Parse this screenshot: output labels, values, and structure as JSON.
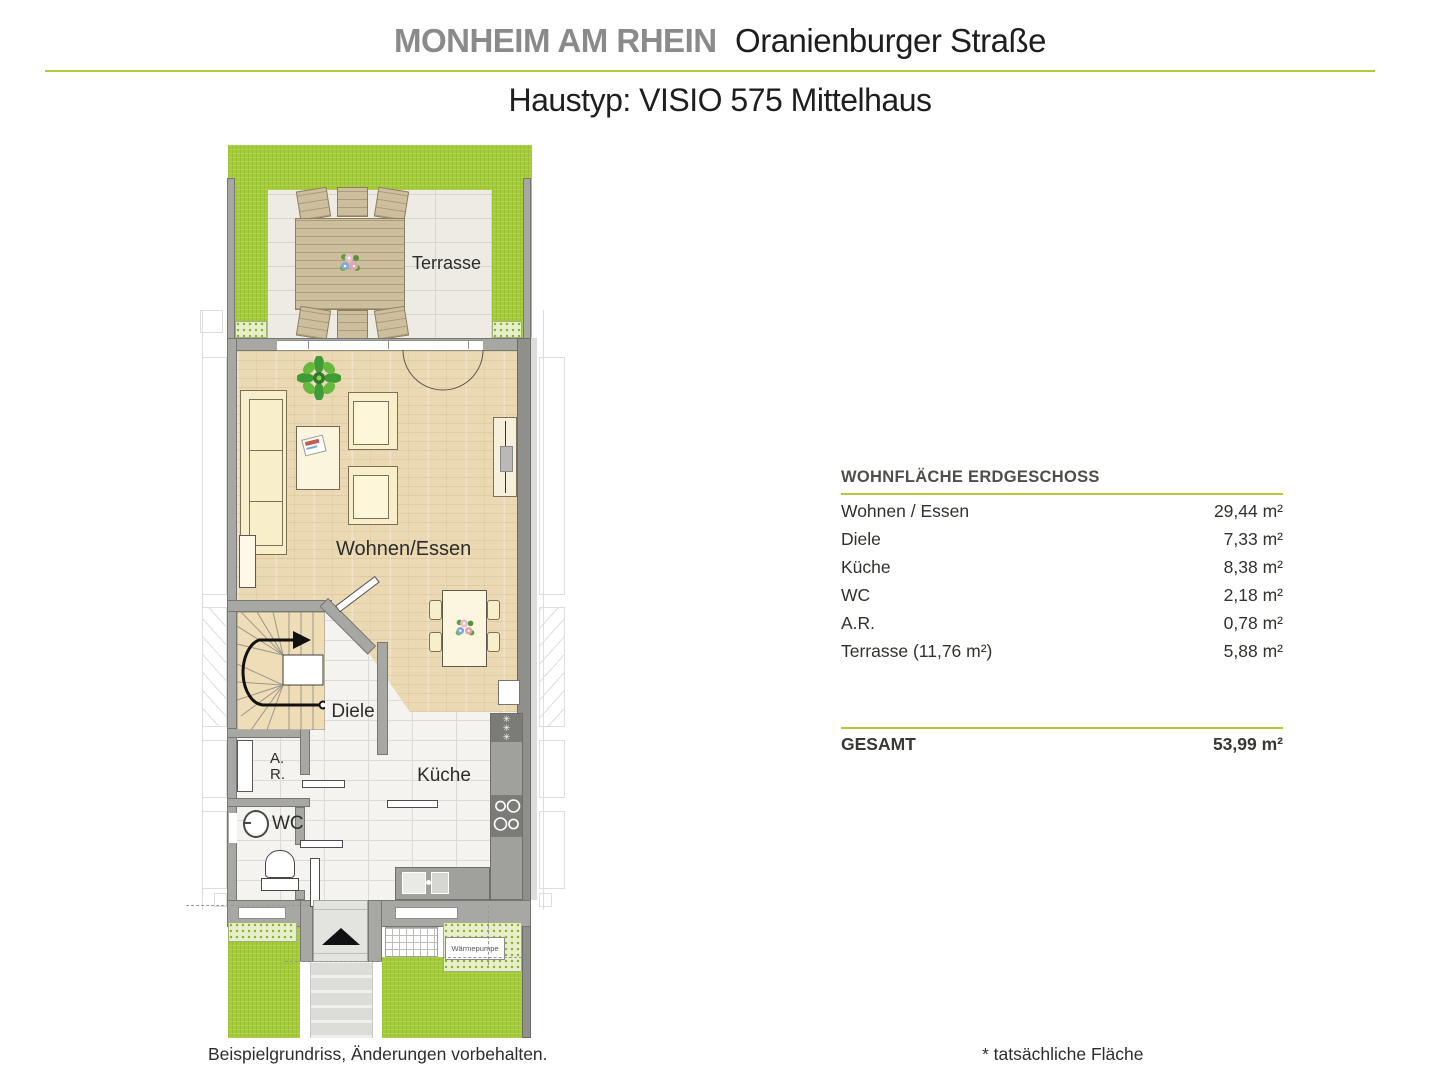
{
  "header": {
    "location": "MONHEIM AM RHEIN",
    "street": "Oranienburger Straße",
    "subtitle": "Haustyp: VISIO 575 Mittelhaus"
  },
  "plan_labels": {
    "terrasse": "Terrasse",
    "wohnen_essen": "Wohnen/Essen",
    "diele": "Diele",
    "ar_line1": "A.",
    "ar_line2": "R.",
    "wc": "WC",
    "kueche": "Küche",
    "waermepumpe": "Wärmepumpe"
  },
  "area_table": {
    "title": "WOHNFLÄCHE ERDGESCHOSS",
    "rows": [
      {
        "label": "Wohnen / Essen",
        "value": "29,44 m²"
      },
      {
        "label": "Diele",
        "value": "7,33 m²"
      },
      {
        "label": "Küche",
        "value": "8,38 m²"
      },
      {
        "label": "WC",
        "value": "2,18 m²"
      },
      {
        "label": "A.R.",
        "value": "0,78 m²"
      },
      {
        "label": "Terrasse (11,76 m²)",
        "value": "5,88 m²"
      }
    ],
    "total_label": "GESAMT",
    "total_value": "53,99 m²"
  },
  "footnotes": {
    "left": "Beispielgrundriss, Änderungen vorbehalten.",
    "right": "* tatsächliche Fläche"
  },
  "colors": {
    "accent_green": "#b6c73a",
    "garden_green": "#a4cc37",
    "wall_gray": "#a7a7a4",
    "wood_floor": "#ebd9b3",
    "tile_floor": "#f4f3f0",
    "terrace_tile": "#edebe3",
    "furniture_cream": "#f8eec9",
    "counter_gray": "#a0a09d"
  }
}
